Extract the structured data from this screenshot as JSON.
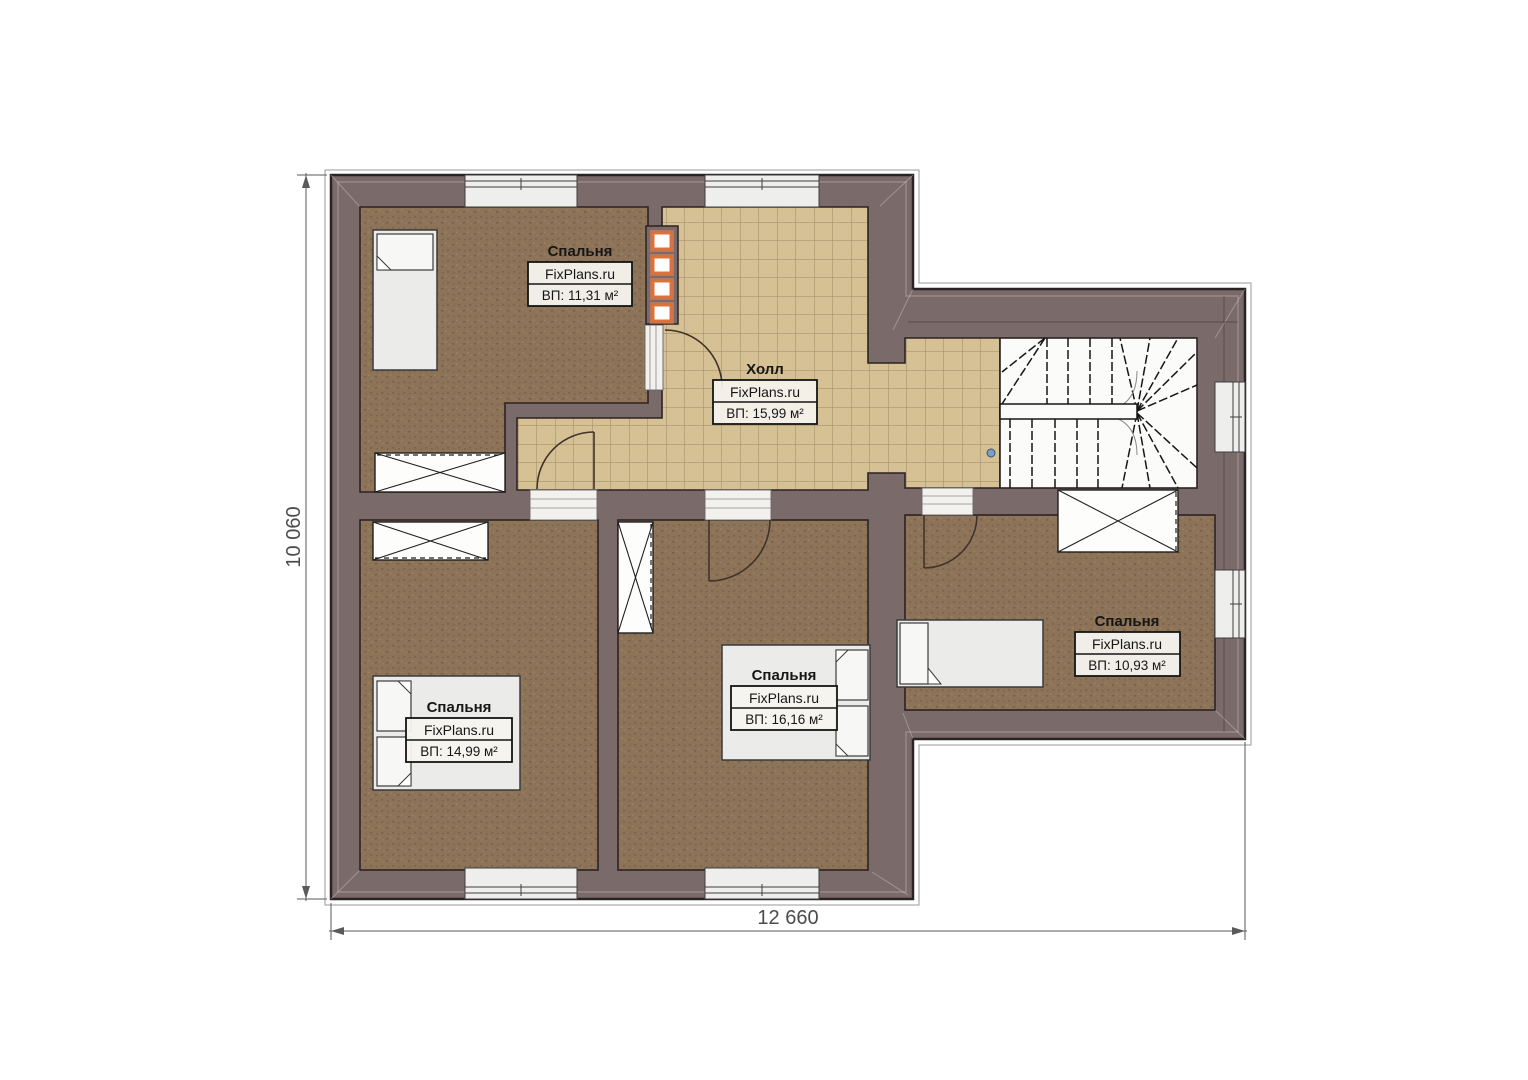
{
  "plan": {
    "type": "floor-plan",
    "rooms": [
      {
        "id": "bedroom-1",
        "title": "Спальня",
        "watermark": "FixPlans.ru",
        "area": "ВП: 11,31 м²"
      },
      {
        "id": "hall",
        "title": "Холл",
        "watermark": "FixPlans.ru",
        "area": "ВП: 15,99 м²"
      },
      {
        "id": "bedroom-2",
        "title": "Спальня",
        "watermark": "FixPlans.ru",
        "area": "ВП: 14,99 м²"
      },
      {
        "id": "bedroom-3",
        "title": "Спальня",
        "watermark": "FixPlans.ru",
        "area": "ВП: 16,16 м²"
      },
      {
        "id": "bedroom-4",
        "title": "Спальня",
        "watermark": "FixPlans.ru",
        "area": "ВП: 10,93 м²"
      }
    ],
    "dimensions": {
      "width_mm": "12 660",
      "height_mm": "10 060"
    },
    "colors": {
      "wall": "#7b6a6a",
      "outline": "#2b2323",
      "carpet": "#8d7458",
      "tile": "#d6c195",
      "vent_accent": "#e0703a",
      "furniture": "#ebebe9"
    }
  }
}
